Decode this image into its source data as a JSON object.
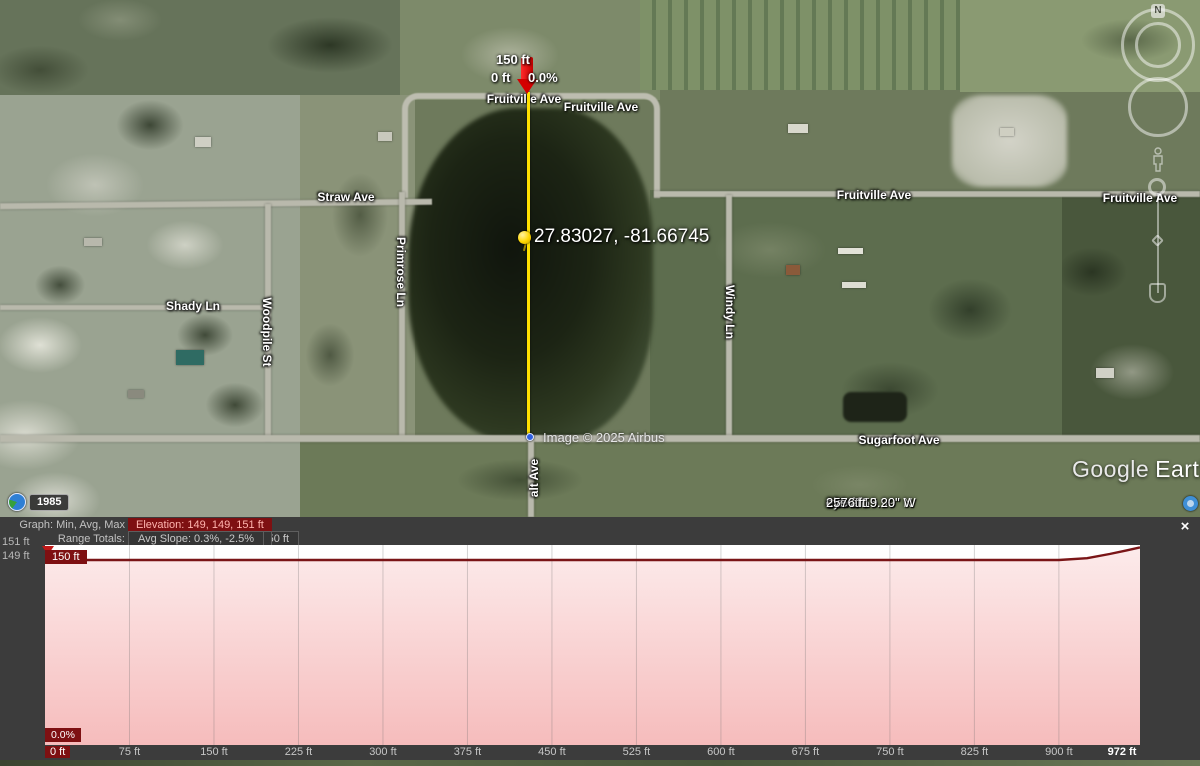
{
  "map": {
    "measurement": {
      "top_label": "150 ft",
      "start_label": "0 ft",
      "slope_label": "0.0%",
      "coordinates_label": "27.83027, -81.66745"
    },
    "streets": [
      {
        "label": "Fruitville Ave",
        "x": 524,
        "y": 99,
        "rot": 0
      },
      {
        "label": "Fruitville Ave",
        "x": 601,
        "y": 107,
        "rot": 0
      },
      {
        "label": "Straw Ave",
        "x": 346,
        "y": 197,
        "rot": 0
      },
      {
        "label": "Fruitville Ave",
        "x": 874,
        "y": 195,
        "rot": 0
      },
      {
        "label": "Fruitville Ave",
        "x": 1140,
        "y": 198,
        "rot": 0
      },
      {
        "label": "Shady Ln",
        "x": 193,
        "y": 306,
        "rot": 0
      },
      {
        "label": "Woodpile St",
        "x": 267,
        "y": 332,
        "rot": 90
      },
      {
        "label": "Primrose Ln",
        "x": 401,
        "y": 272,
        "rot": 90
      },
      {
        "label": "Windy Ln",
        "x": 730,
        "y": 312,
        "rot": 90
      },
      {
        "label": "Sugarfoot Ave",
        "x": 899,
        "y": 440,
        "rot": 0
      },
      {
        "label": "alt Ave",
        "x": 534,
        "y": 478,
        "rot": -90
      }
    ],
    "watermark": "Image © 2025 Airbus",
    "logo": {
      "google": "Google",
      "earth": "Earth"
    },
    "status_bar": {
      "lat": "27°49'55.99\" N",
      "lon": "81°40'19.20\" W",
      "elev_label": "elev",
      "elev_value": "156 ft",
      "eye_alt_label": "eye alt",
      "eye_alt_value": "2576 ft"
    },
    "time_indicator": "1985",
    "compass_n": "N"
  },
  "elevation_panel": {
    "graph_label": "Graph: Min, Avg, Max",
    "elevation_stat": "Elevation: 149, 149, 151 ft",
    "range_totals_label": "Range Totals:",
    "stats": [
      "Distance: 972 ft",
      "Elev Gain/Loss: 2.98 ft, -1.50 ft",
      "Max Slope: 14.3%, -8.5%",
      "Avg Slope: 0.3%, -2.5%"
    ],
    "y_axis_labels": [
      "151 ft",
      "149 ft"
    ],
    "cursor": {
      "elevation": "150 ft",
      "slope": "0.0%"
    },
    "close_label": "×"
  },
  "chart_data": {
    "type": "area",
    "title": "Elevation profile",
    "xlabel": "distance (ft)",
    "ylabel": "elevation (ft)",
    "x_range_ft": [
      0,
      972
    ],
    "y_min_ft": 149,
    "y_avg_ft": 149,
    "y_max_ft": 151,
    "x_ticks": [
      {
        "ft": 0,
        "label": "0 ft"
      },
      {
        "ft": 75,
        "label": "75 ft"
      },
      {
        "ft": 150,
        "label": "150 ft"
      },
      {
        "ft": 225,
        "label": "225 ft"
      },
      {
        "ft": 300,
        "label": "300 ft"
      },
      {
        "ft": 375,
        "label": "375 ft"
      },
      {
        "ft": 450,
        "label": "450 ft"
      },
      {
        "ft": 525,
        "label": "525 ft"
      },
      {
        "ft": 600,
        "label": "600 ft"
      },
      {
        "ft": 675,
        "label": "675 ft"
      },
      {
        "ft": 750,
        "label": "750 ft"
      },
      {
        "ft": 825,
        "label": "825 ft"
      },
      {
        "ft": 900,
        "label": "900 ft"
      },
      {
        "ft": 972,
        "label": "972 ft"
      }
    ],
    "points": [
      {
        "ft": 0,
        "elev": 150.0
      },
      {
        "ft": 450,
        "elev": 150.0
      },
      {
        "ft": 900,
        "elev": 150.0
      },
      {
        "ft": 925,
        "elev": 150.15
      },
      {
        "ft": 945,
        "elev": 150.5
      },
      {
        "ft": 960,
        "elev": 150.8
      },
      {
        "ft": 972,
        "elev": 151.05
      }
    ]
  },
  "colors": {
    "measure_line": "#ffe000",
    "marker_red": "#d40000",
    "profile_line": "#7a1517",
    "profile_fill_top": "#fcebeb",
    "profile_fill_bottom": "#f6bcbc",
    "cursor_box": "#7e1012",
    "panel_bg": "#3c3c3c"
  }
}
